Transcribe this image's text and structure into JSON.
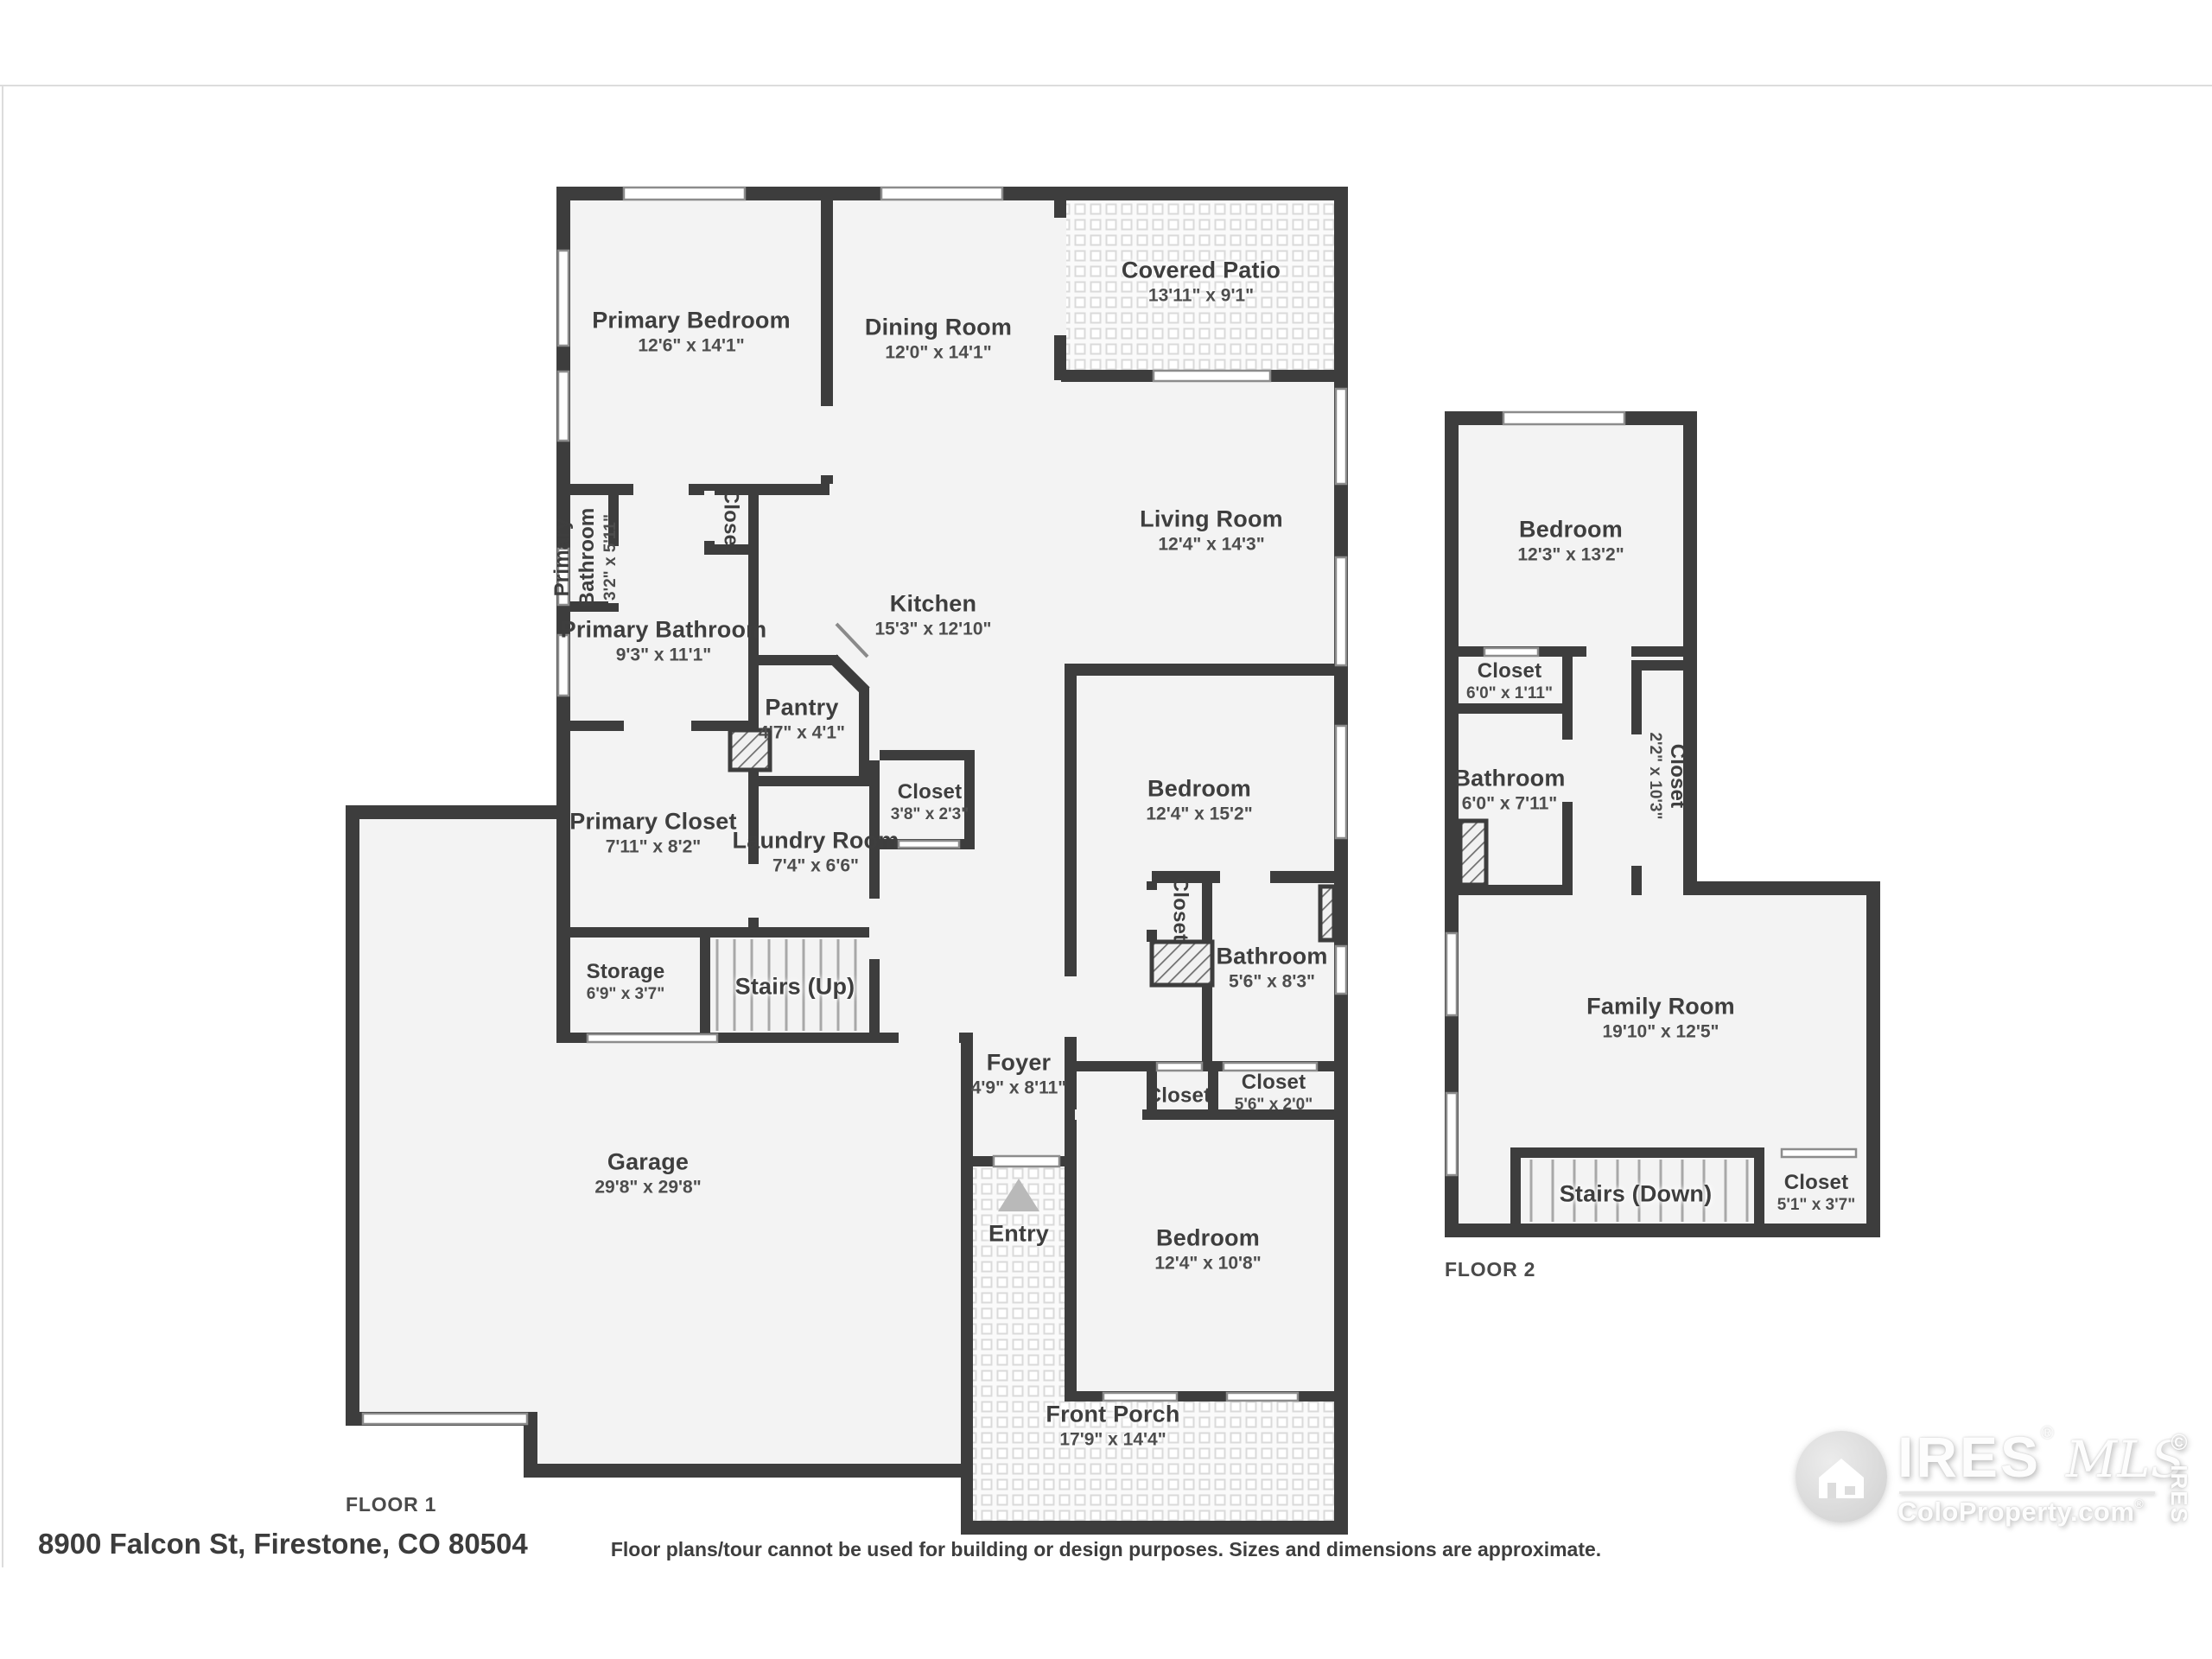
{
  "footer": {
    "address": "8900 Falcon St, Firestone, CO 80504",
    "disclaimer": "Floor plans/tour cannot be used for building or design purposes. Sizes and dimensions are approximate.",
    "floor1_label": "FLOOR 1",
    "floor2_label": "FLOOR 2"
  },
  "logo": {
    "brand": "IRES",
    "script": "MLS",
    "site": "ColoProperty.com",
    "registered": "®",
    "copyright": "© IRES"
  },
  "floor1": {
    "rooms": [
      {
        "name": "Primary Bedroom",
        "dims": "12'6\" x 14'1\""
      },
      {
        "name": "Dining Room",
        "dims": "12'0\" x 14'1\""
      },
      {
        "name": "Covered Patio",
        "dims": "13'11\" x 9'1\""
      },
      {
        "name": "Living Room",
        "dims": "12'4\" x 14'3\""
      },
      {
        "name": "Kitchen",
        "dims": "15'3\" x 12'10\""
      },
      {
        "name": "Primary Bathroom",
        "dims": "3'2\" x 5'11\""
      },
      {
        "name": "Closet",
        "dims": ""
      },
      {
        "name": "Primary Bathroom",
        "dims": "9'3\" x 11'1\""
      },
      {
        "name": "Pantry",
        "dims": "4'7\" x 4'1\""
      },
      {
        "name": "Primary Closet",
        "dims": "7'11\" x 8'2\""
      },
      {
        "name": "Laundry Room",
        "dims": "7'4\" x 6'6\""
      },
      {
        "name": "Closet",
        "dims": "3'8\" x 2'3\""
      },
      {
        "name": "Storage",
        "dims": "6'9\" x 3'7\""
      },
      {
        "name": "Stairs (Up)",
        "dims": ""
      },
      {
        "name": "Garage",
        "dims": "29'8\" x 29'8\""
      },
      {
        "name": "Bedroom",
        "dims": "12'4\" x 15'2\""
      },
      {
        "name": "Closet",
        "dims": ""
      },
      {
        "name": "Bathroom",
        "dims": "5'6\" x 8'3\""
      },
      {
        "name": "Foyer",
        "dims": "4'9\" x 8'11\""
      },
      {
        "name": "Closet",
        "dims": ""
      },
      {
        "name": "Closet",
        "dims": "5'6\" x 2'0\""
      },
      {
        "name": "Entry",
        "dims": ""
      },
      {
        "name": "Bedroom",
        "dims": "12'4\" x 10'8\""
      },
      {
        "name": "Front Porch",
        "dims": "17'9\" x 14'4\""
      }
    ]
  },
  "floor2": {
    "rooms": [
      {
        "name": "Bedroom",
        "dims": "12'3\" x 13'2\""
      },
      {
        "name": "Closet",
        "dims": "6'0\" x 1'11\""
      },
      {
        "name": "Bathroom",
        "dims": "6'0\" x 7'11\""
      },
      {
        "name": "Closet",
        "dims": "2'2\" x 10'3\""
      },
      {
        "name": "Family Room",
        "dims": "19'10\" x 12'5\""
      },
      {
        "name": "Stairs (Down)",
        "dims": ""
      },
      {
        "name": "Closet",
        "dims": "5'1\" x 3'7\""
      }
    ]
  }
}
